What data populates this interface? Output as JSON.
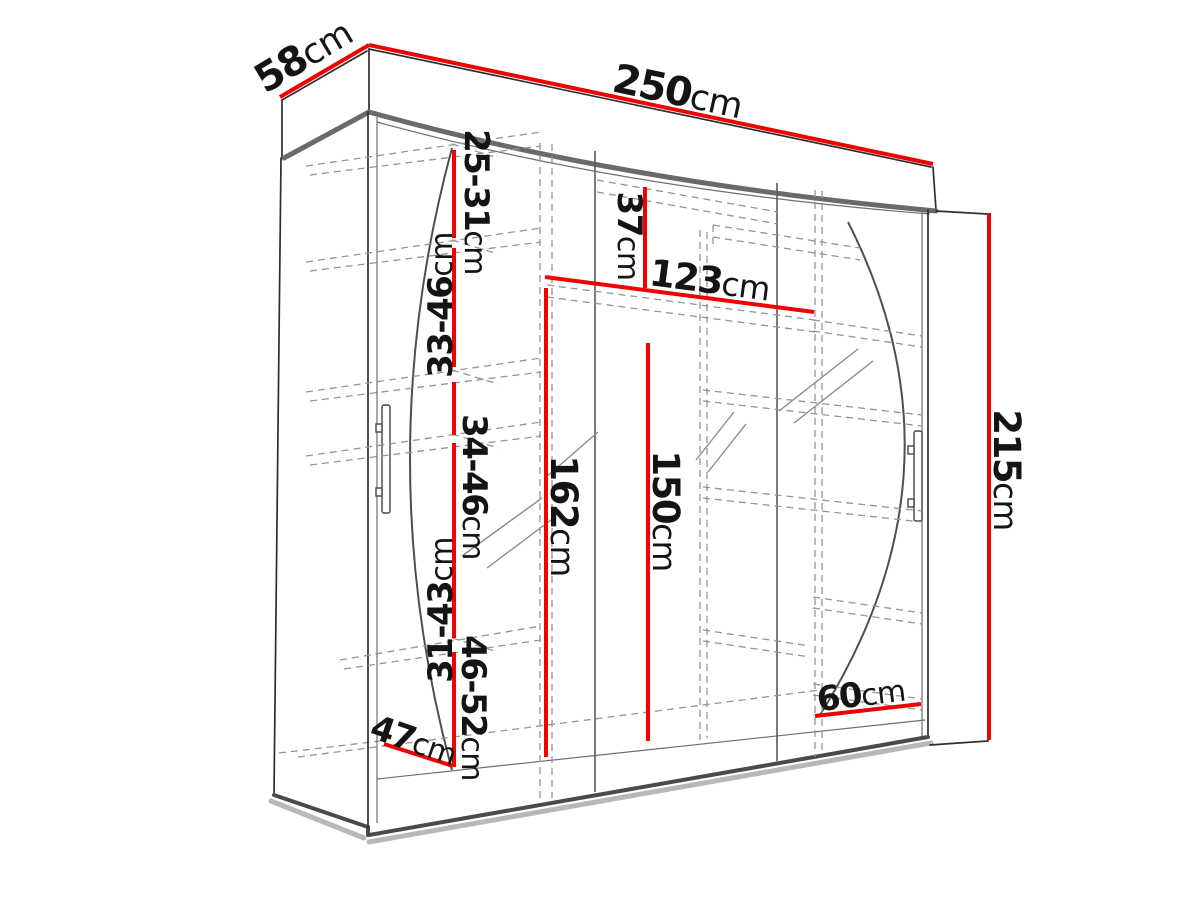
{
  "diagram": {
    "kind": "wardrobe-3-sliding-door-dimension-drawing",
    "accent_color": "#ee0202",
    "line_color": "#2e2e2e",
    "dashed_color": "#949494",
    "background": "#ffffff",
    "dimensions": {
      "top_depth": {
        "num": "58",
        "unit": "cm"
      },
      "top_width": {
        "num": "250",
        "unit": "cm"
      },
      "right_height": {
        "num": "215",
        "unit": "cm"
      },
      "shelf_gap_1": {
        "num": "25-31",
        "unit": "cm"
      },
      "shelf_gap_2": {
        "num": "33-46",
        "unit": "cm"
      },
      "shelf_gap_3": {
        "num": "34-46",
        "unit": "cm"
      },
      "shelf_gap_4": {
        "num": "31-43",
        "unit": "cm"
      },
      "shelf_gap_5": {
        "num": "46-52",
        "unit": "cm"
      },
      "top_compartment": {
        "num": "37",
        "unit": "cm"
      },
      "inner_shelf_width": {
        "num": "123",
        "unit": "cm"
      },
      "left_inner_height": {
        "num": "162",
        "unit": "cm"
      },
      "hanging_height": {
        "num": "150",
        "unit": "cm"
      },
      "bottom_width": {
        "num": "60",
        "unit": "cm"
      },
      "bottom_depth": {
        "num": "47",
        "unit": "cm"
      }
    }
  }
}
